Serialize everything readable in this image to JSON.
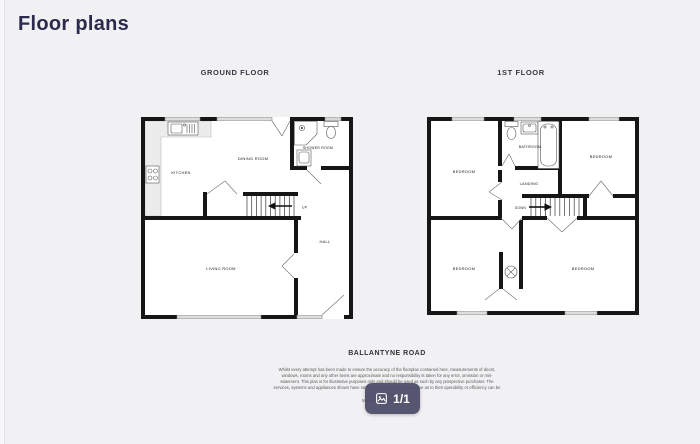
{
  "page": {
    "title": "Floor plans",
    "colors": {
      "background": "#f1f0f2",
      "title_text": "#2a2a4c",
      "plan_lines": "#161616",
      "badge_background": "#4a4a66",
      "badge_text": "#ffffff"
    }
  },
  "plans": {
    "ground": {
      "title": "GROUND FLOOR",
      "rooms": {
        "kitchen": "KITCHEN",
        "dining": "DINING ROOM",
        "shower": "SHOWER ROOM",
        "living": "LIVING ROOM",
        "hall": "HALL"
      },
      "stairs_label": "UP"
    },
    "first": {
      "title": "1ST FLOOR",
      "rooms": {
        "bathroom": "BATHROOM",
        "landing": "LANDING",
        "bedroom_tl": "BEDROOM",
        "bedroom_tr": "BEDROOM",
        "bedroom_bl": "BEDROOM",
        "bedroom_br": "BEDROOM"
      },
      "stairs_label": "DOWN"
    }
  },
  "footer": {
    "address": "BALLANTYNE ROAD",
    "disclaimer": "Whilst every attempt has been made to ensure the accuracy of the floorplan contained here, measurements of doors, windows, rooms and any other items are approximate and no responsibility is taken for any error, omission or mis-statement. This plan is for illustrative purposes only and should be used as such by any prospective purchaser. The services, systems and appliances shown have not been tested and no guarantee as to their operability or efficiency can be given.",
    "credit": "Made with Metropix ©2022"
  },
  "pager": {
    "label": "1/1",
    "icon": "photos-icon"
  }
}
